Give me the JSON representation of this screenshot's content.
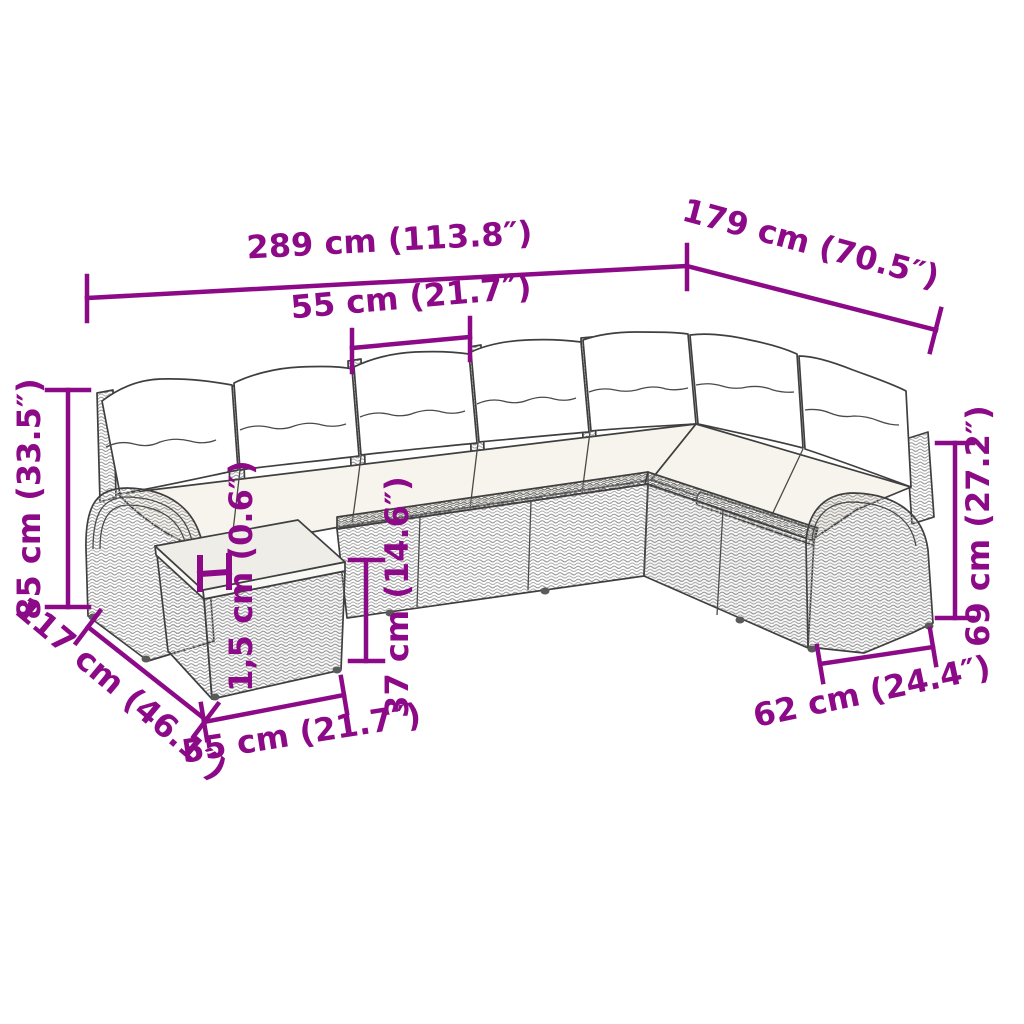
{
  "diagram": {
    "accent_color": "#8c0a87",
    "line_color": "#3f3f3f",
    "measurements": {
      "overall_width": "289 cm (113.8″)",
      "right_depth": "179 cm (70.5″)",
      "seat_width": "55 cm (21.7″)",
      "overall_height": "85 cm (33.5″)",
      "left_depth": "117 cm (46.1″)",
      "table_width": "55 cm (21.7″)",
      "glass_thickness": "1,5 cm (0.6″)",
      "table_height": "37 cm (14.6″)",
      "arm_height": "69 cm (27.2″)",
      "seat_depth": "62 cm (24.4″)"
    }
  }
}
